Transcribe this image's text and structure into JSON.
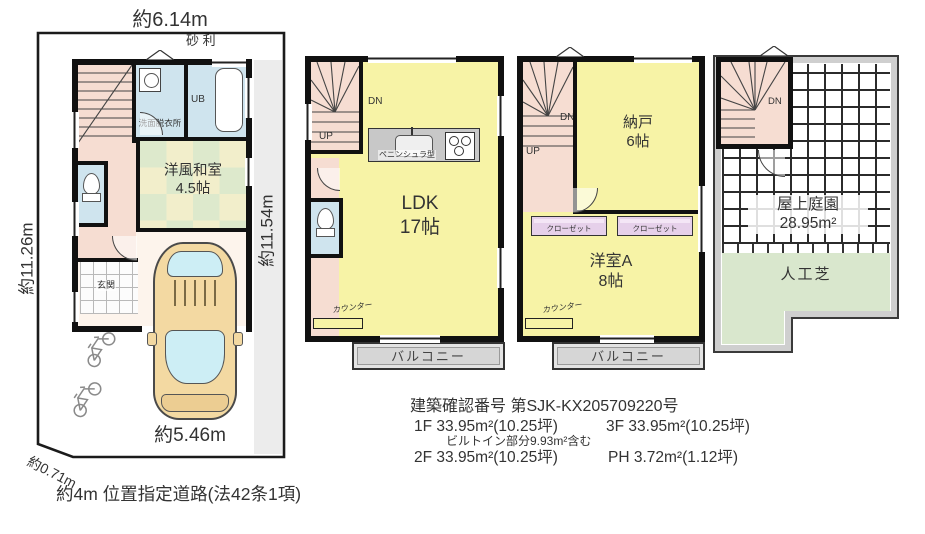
{
  "site": {
    "dim_top": "約6.14m",
    "dim_left": "約11.26m",
    "dim_right": "約11.54m",
    "dim_bottom": "約5.46m",
    "dim_corner": "約0.71m",
    "road": "約4m 位置指定道路(法42条1項)",
    "gravel": "砂 利"
  },
  "f1": {
    "washroom": "洗面脱衣所",
    "bath": "UB",
    "tatami_name": "洋風和室",
    "tatami_size": "4.5帖",
    "entrance": "玄関"
  },
  "f2": {
    "dn": "DN",
    "up": "UP",
    "kitchen_type": "ペニンシュラ型",
    "ldk_name": "LDK",
    "ldk_size": "17帖",
    "counter": "カウンター",
    "balcony": "バルコニー"
  },
  "f3": {
    "dn": "DN",
    "up": "UP",
    "storage_name": "納戸",
    "storage_size": "6帖",
    "closet_left": "クローゼット",
    "closet_right": "クローゼット",
    "room_name": "洋室A",
    "room_size": "8帖",
    "counter": "カウンター",
    "balcony": "バルコニー"
  },
  "ph": {
    "dn": "DN",
    "garden_name": "屋上庭園",
    "garden_area": "28.95m²",
    "turf": "人工芝"
  },
  "info": {
    "confirm_no": "建築確認番号 第SJK-KX205709220号",
    "f1": "1F 33.95m²(10.25坪)",
    "f3": "3F 33.95m²(10.25坪)",
    "builtin": "ビルトイン部分9.93m²含む",
    "f2": "2F 33.95m²(10.25坪)",
    "ph": "PH 3.72m²(1.12坪)"
  },
  "colors": {
    "room_yellow": "#f7f3a6",
    "stair_pink": "#f6ddd2",
    "wet_blue": "#cfe4ee",
    "closet_purple": "#e6d0ea",
    "balcony_gray": "#dadada",
    "turf_green": "#d9e7cd",
    "tatami_yellow": "#f2eecb",
    "tatami_green": "#dde9cc",
    "car_tan": "#f3d9a2",
    "glass_blue": "#cdeef5",
    "wall_black": "#111111"
  }
}
